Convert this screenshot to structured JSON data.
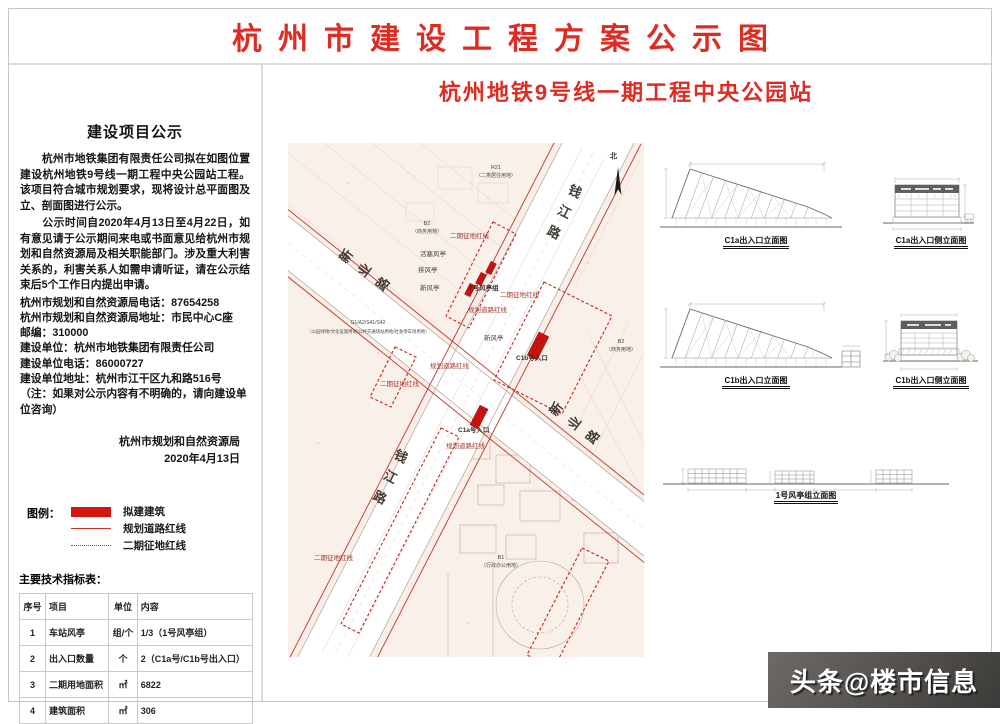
{
  "title": "杭州市建设工程方案公示图",
  "subtitle": "杭州地铁9号线一期工程中央公园站",
  "notice": {
    "heading": "建设项目公示",
    "para1": "　　杭州市地铁集团有限责任公司拟在如图位置建设杭州地铁9号线一期工程中央公园站工程。该项目符合城市规划要求，现将设计总平面图及立、剖面图进行公示。",
    "para2": "　　公示时间自2020年4月13日至4月22日，如有意见请于公示期间来电或书面意见给杭州市规划和自然资源局及相关职能部门。涉及重大利害关系的，利害关系人如需申请听证，请在公示结束后5个工作日内提出申请。",
    "line_phone": "杭州市规划和自然资源局电话：87654258",
    "line_addr": "杭州市规划和自然资源局地址：市民中心C座",
    "line_zip": "邮编：310000",
    "line_unit": "建设单位：杭州市地铁集团有限责任公司",
    "line_unit_phone": "建设单位电话：86000727",
    "line_unit_addr": "建设单位地址：杭州市江干区九和路516号",
    "line_note": "（注：如果对公示内容有不明确的，请向建设单位咨询）",
    "agency": "杭州市规划和自然资源局",
    "date": "2020年4月13日"
  },
  "legend": {
    "label": "图例：",
    "items": [
      {
        "label": "拟建建筑",
        "type": "block"
      },
      {
        "label": "规划道路红线",
        "type": "line"
      },
      {
        "label": "二期征地红线",
        "type": "dashed"
      }
    ]
  },
  "table": {
    "title": "主要技术指标表：",
    "headers": [
      "序号",
      "项目",
      "单位",
      "内容"
    ],
    "rows": [
      [
        "1",
        "车站风亭",
        "组/个",
        "1/3（1号风亭组）"
      ],
      [
        "2",
        "出入口数量",
        "个",
        "2（C1a号/C1b号出入口）"
      ],
      [
        "3",
        "二期用地面积",
        "㎡",
        "6822"
      ],
      [
        "4",
        "建筑面积",
        "㎡",
        "306"
      ]
    ]
  },
  "map": {
    "labels": [
      {
        "t": "新业路"
      },
      {
        "t": "钱江路"
      },
      {
        "t": "新业路"
      },
      {
        "t": "钱江路"
      },
      {
        "t": "R21"
      },
      {
        "t": "（二类居住用地）"
      },
      {
        "t": "二期征地红线"
      },
      {
        "t": "活塞风亭"
      },
      {
        "t": "排风亭"
      },
      {
        "t": "新风亭"
      },
      {
        "t": "1号风亭组"
      },
      {
        "t": "规划道路红线"
      },
      {
        "t": "二期征地红线"
      },
      {
        "t": "新风亭"
      },
      {
        "t": "C1b号入口"
      },
      {
        "t": "规划道路红线"
      },
      {
        "t": "二期征地红线"
      },
      {
        "t": "C1a号入口"
      },
      {
        "t": "规划道路红线"
      },
      {
        "t": "G1/A2/S41/S42"
      },
      {
        "t": "（公园绿地/文化设施用地/公共交通场站用地/社会停车场用地）"
      },
      {
        "t": "B2"
      },
      {
        "t": "（商务用地）"
      },
      {
        "t": "B2"
      },
      {
        "t": "（商务用地）"
      },
      {
        "t": "B1"
      },
      {
        "t": "（行政办公用地）"
      },
      {
        "t": "二期征地红线"
      },
      {
        "t": "北"
      }
    ]
  },
  "elevations": {
    "captions": [
      "C1a出入口立面图",
      "C1a出入口侧立面图",
      "C1b出入口立面图",
      "C1b出入口侧立面图",
      "1号风亭组立面图"
    ]
  },
  "watermark": "头条@楼市信息",
  "colors": {
    "accent_red": "#df2b22",
    "building_red": "#c51310",
    "redline": "#c2362b",
    "map_bg": "#faf0ea",
    "watermark_bg": "#3d3b39"
  }
}
